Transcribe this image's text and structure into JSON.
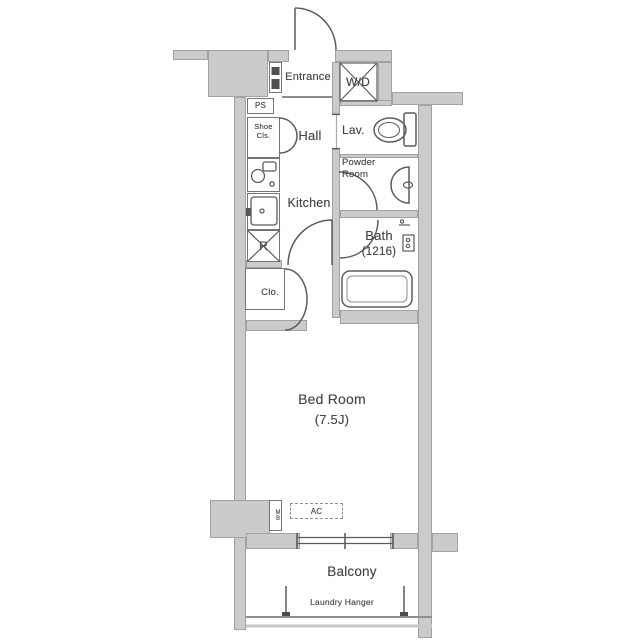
{
  "colors": {
    "wall_fill": "#cbcbcb",
    "wall_edge": "#a2a2a2",
    "line": "#5c5c5c",
    "text": "#464646",
    "background": "#ffffff"
  },
  "rooms": {
    "entrance": {
      "label": "Entrance"
    },
    "washer_dryer": {
      "label": "W/D"
    },
    "pipe_space": {
      "label": "PS"
    },
    "shoe_closet": {
      "label": "Shoe\nCls."
    },
    "hall": {
      "label": "Hall"
    },
    "lavatory": {
      "label": "Lav."
    },
    "powder_room": {
      "label": "Powder\nRoom"
    },
    "kitchen": {
      "label": "Kitchen"
    },
    "bath": {
      "label": "Bath",
      "size": "(1216)"
    },
    "refrigerator": {
      "label": "R"
    },
    "closet": {
      "label": "Clo."
    },
    "bedroom": {
      "label": "Bed Room",
      "size": "(7.5J)"
    },
    "air_conditioner": {
      "label": "AC"
    },
    "meter_box": {
      "label": "MB"
    },
    "balcony": {
      "label": "Balcony"
    },
    "laundry_hanger": {
      "label": "Laundry Hanger"
    }
  }
}
